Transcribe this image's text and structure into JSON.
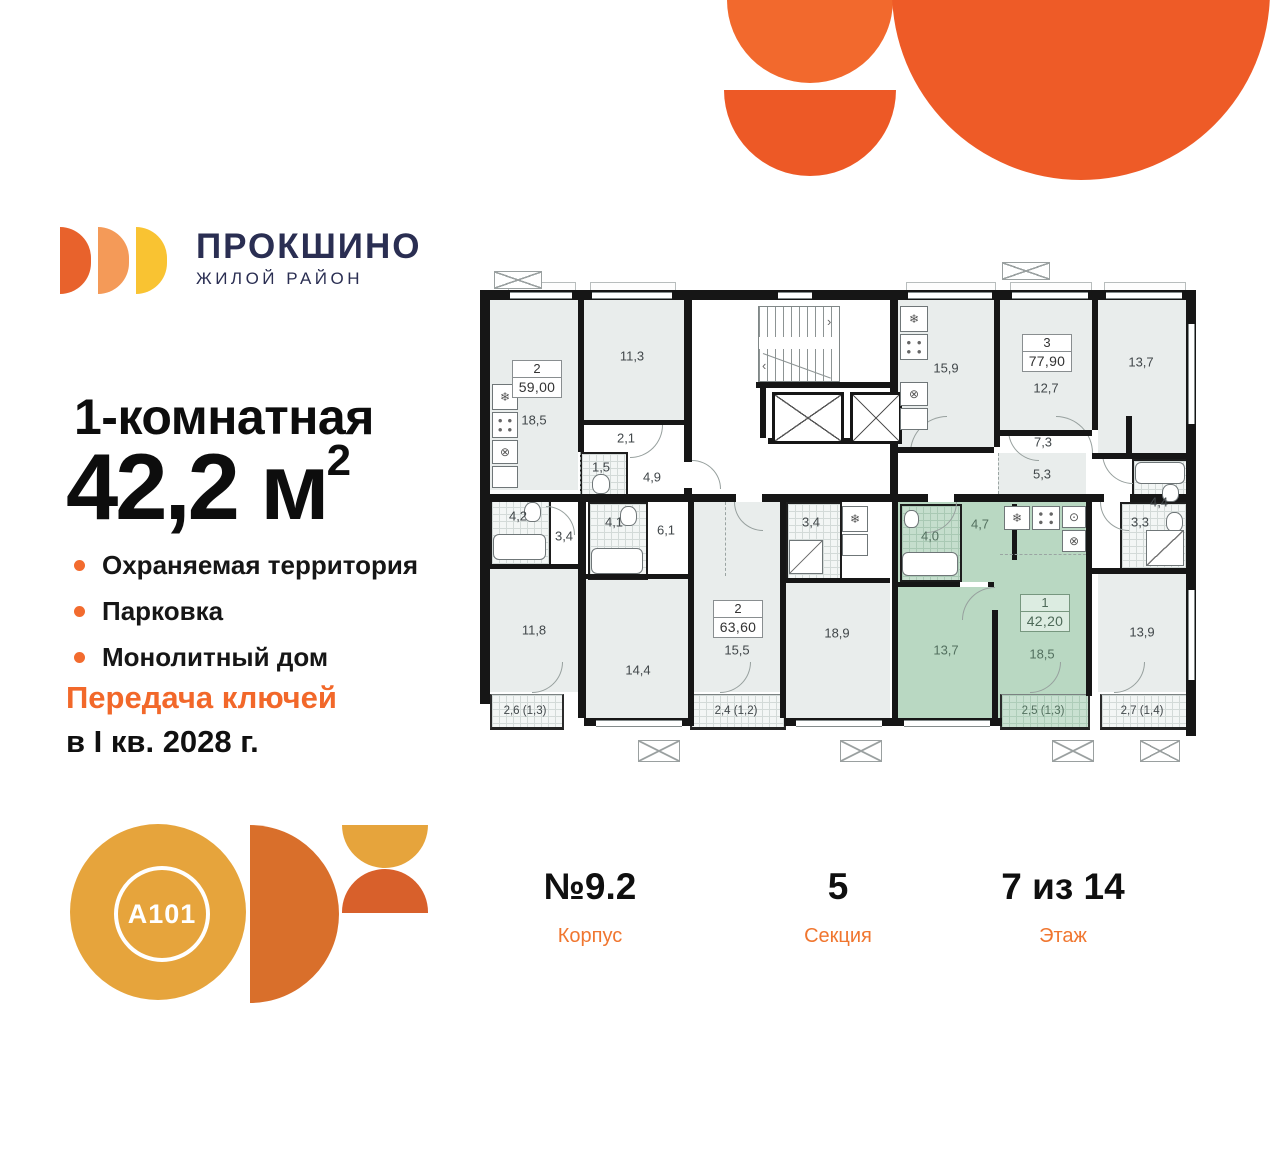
{
  "branding": {
    "district_title": "ПРОКШИНО",
    "district_subtitle": "ЖИЛОЙ РАЙОН",
    "developer_logo_text": "A101"
  },
  "listing": {
    "type_title": "1-комнатная",
    "area_value": "42,2",
    "area_unit": " м",
    "area_sup": "2",
    "features": [
      "Охраняемая территория",
      "Парковка",
      "Монолитный дом"
    ],
    "handover_line1": "Передача ключей",
    "handover_line2": "в I кв. 2028 г."
  },
  "meta": {
    "corpus_value": "№9.2",
    "corpus_label": "Корпус",
    "section_value": "5",
    "section_label": "Секция",
    "floor_value": "7 из 14",
    "floor_label": "Этаж"
  },
  "floorplan": {
    "a": {
      "count": "2",
      "total": "59,00",
      "kitchen": "18,5",
      "room1": "11,3",
      "hall": "2,1",
      "wc": "1,5",
      "hallway": "4,9",
      "bath": "4,2",
      "corridor": "3,4",
      "room2": "11,8",
      "balcony": "2,6 (1,3)"
    },
    "b": {
      "count": "2",
      "total": "63,60",
      "bath": "4,1",
      "hall": "6,1",
      "room1": "14,4",
      "room2": "15,5",
      "wc": "3,4",
      "kitchen": "18,9",
      "balcony": "2,4 (1,2)"
    },
    "c": {
      "count": "3",
      "total": "77,90",
      "kitchen": "15,9",
      "room1": "12,7",
      "room2": "13,7",
      "hall": "7,3",
      "corridor": "5,3",
      "bath": "4,4"
    },
    "d": {
      "bath": "3,3",
      "room": "13,9",
      "balcony": "2,7 (1,4)"
    },
    "sel": {
      "count": "1",
      "total": "42,20",
      "bath": "4,0",
      "hall": "4,7",
      "room": "13,7",
      "kitchen": "18,5",
      "balcony": "2,5 (1,3)"
    }
  },
  "colors": {
    "accent_orange": "#F2682A",
    "highlight_green": "#B9D8C2",
    "navy": "#2A2E52"
  }
}
